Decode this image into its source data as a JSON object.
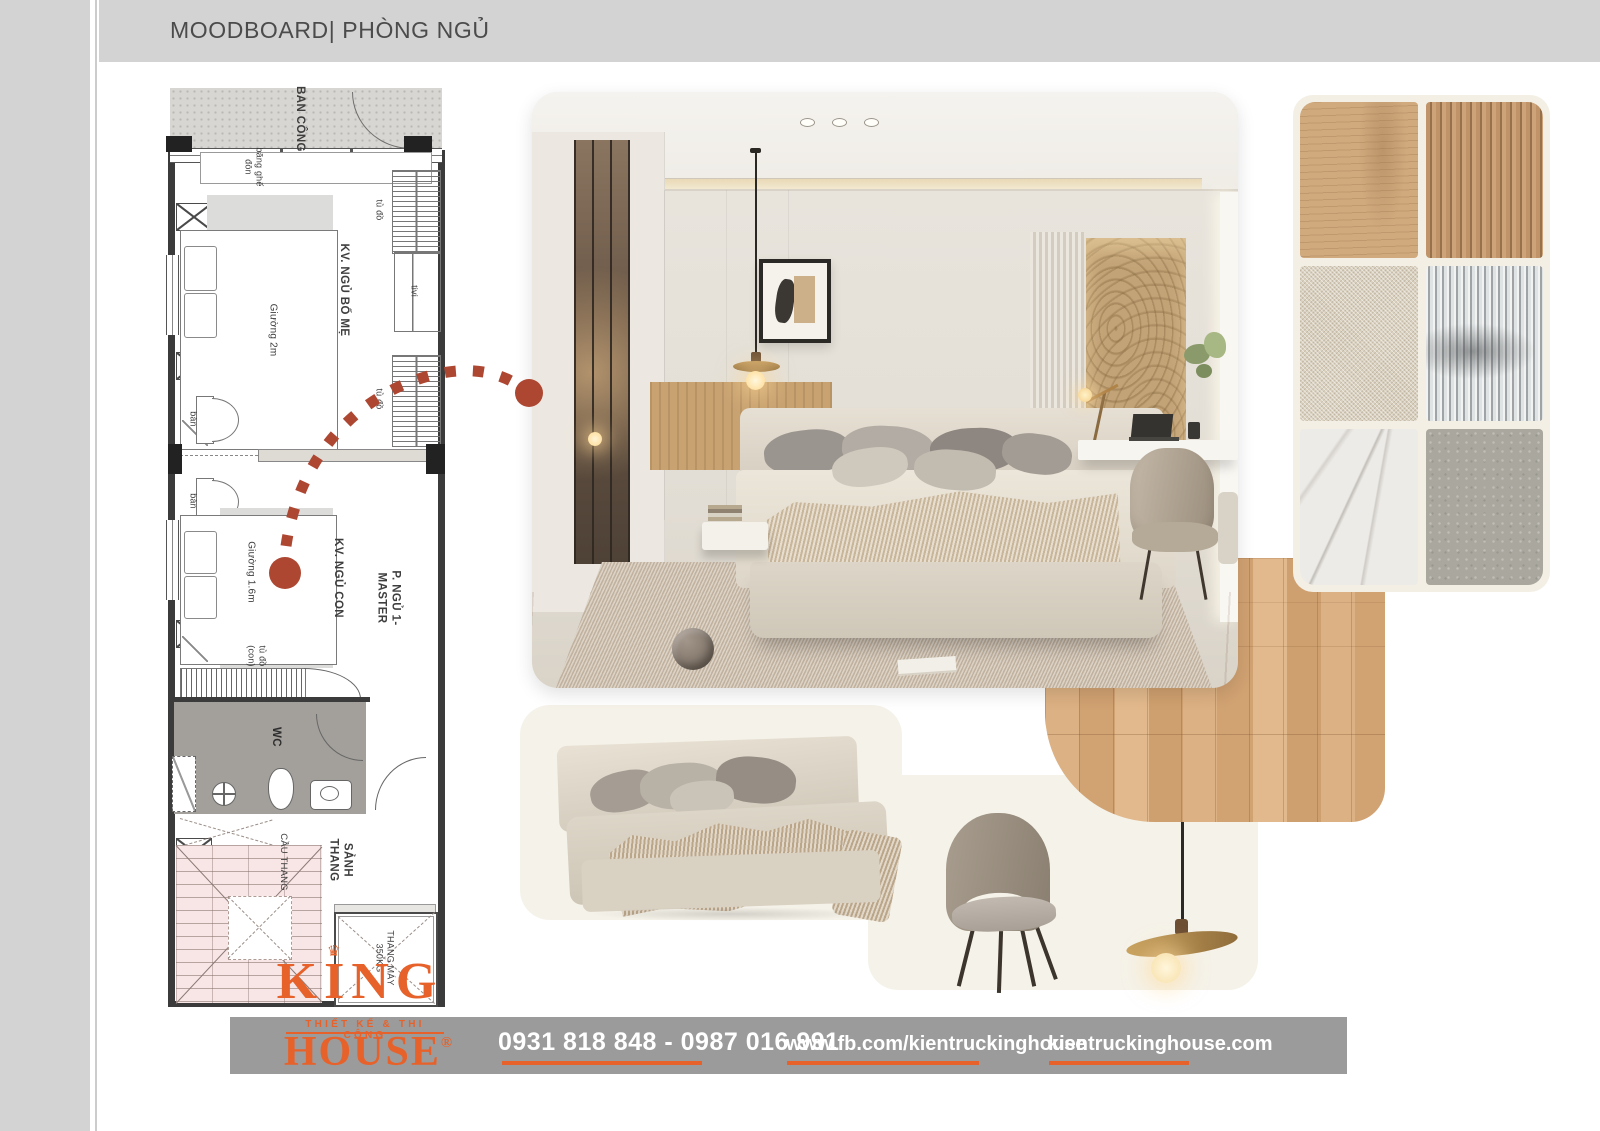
{
  "header": {
    "title": "MOODBOARD| PHÒNG NGỦ"
  },
  "plan": {
    "balcony": "BAN CÔNG",
    "bench": "băng ghế\nđôn",
    "parents_area": "KV. NGỦ BỐ MẸ",
    "bed_2m": "Giường 2m",
    "wardrobe": "tủ đồ",
    "tv": "tivi",
    "desk": "bàn",
    "child_area": "KV. NGỦ CON",
    "bed_1_6m": "Giường 1.6m",
    "master_room": "P. NGỦ 1-\nMASTER",
    "child_wardrobe": "tủ đồ\n(con)",
    "wc": "WC",
    "stair_hall": "SẢNH\nTHANG",
    "stairs": "CẦU THANG",
    "elevator": "THANG MÁY\n350KG"
  },
  "logo": {
    "brand": "KING",
    "crown": "♛",
    "tagline": "THIẾT KẾ & THI CÔNG",
    "sub_brand": "HOUSE",
    "registered": "®"
  },
  "footer": {
    "phone": "0931 818 848 - 0987 016 991",
    "facebook": "www.fb.com/kientruckinghouse",
    "website": "kientruckinghouse.com"
  },
  "moodboard": {
    "render": "master-bedroom-3d-render",
    "materials": [
      "light-oak-veneer",
      "wood-slat-panel",
      "beige-boucle-fabric",
      "fluted-glass",
      "white-marble",
      "gray-concrete"
    ],
    "furniture": [
      "upholstered-bed",
      "accent-armchair",
      "pendant-lamp",
      "oak-plank-flooring"
    ]
  },
  "colors": {
    "accent_orange": "#e7622b",
    "connector_red": "#ad4732",
    "header_gray": "#d3d3d3",
    "footer_gray": "#9b9b9b",
    "plan_pink": "#f8e6e7",
    "card_cream": "#f5f2e9"
  }
}
